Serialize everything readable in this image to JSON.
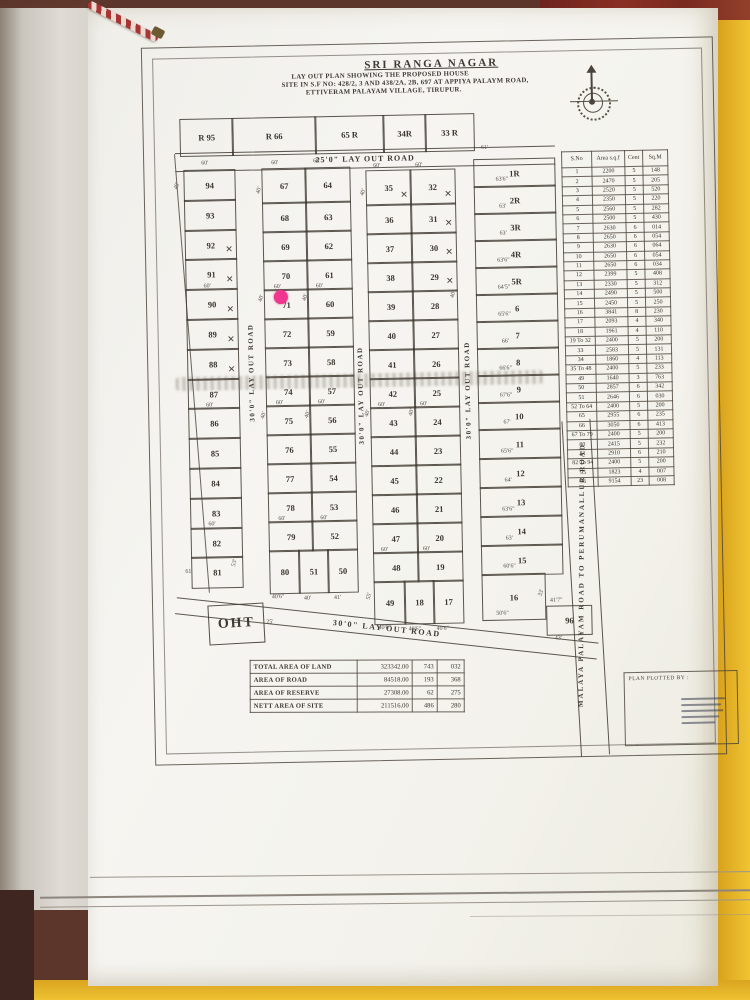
{
  "photo": {
    "folder_color": "#eec232",
    "cloth_color": "#8a2f24",
    "paper_color": "#f6f5f1",
    "ink_color": "#3e3933",
    "marker_color": "#f0368f"
  },
  "title": {
    "name": "SRI RANGA NAGAR",
    "line1": "LAY OUT PLAN SHOWING THE PROPOSED HOUSE",
    "line2": "SITE IN S.F NO: 428/2, 3 AND 438/2A, 2B, 697 AT APPIYA PALAYM ROAD,",
    "line3": "ETTIVERAM PALAYAM VILLAGE, TIRUPUR."
  },
  "roads": {
    "top": "25'0\" LAY OUT ROAD",
    "v1": "30'0\" LAY OUT ROAD",
    "v2": "30'0\" LAY OUT ROAD",
    "v3": "30'0\" LAY OUT ROAD",
    "bottom": "30'0\" LAY OUT ROAD",
    "right": "MALAYA PALAYAM ROAD TO PERUMANALLUR ROAD"
  },
  "oht_label": "OHT",
  "plotted_by_label": "PLAN PLOTTED BY :",
  "marker": {
    "on_plot": "71"
  },
  "area_table": {
    "headers": [
      "S.No",
      "Area s.q.f",
      "Cent",
      "Sq.M"
    ],
    "rows": [
      [
        "1",
        "2200",
        "5",
        "148"
      ],
      [
        "2",
        "2470",
        "5",
        "205"
      ],
      [
        "3",
        "2520",
        "5",
        "520"
      ],
      [
        "4",
        "2350",
        "5",
        "220"
      ],
      [
        "5",
        "2560",
        "5",
        "282"
      ],
      [
        "6",
        "2500",
        "5",
        "430"
      ],
      [
        "7",
        "2630",
        "6",
        "014"
      ],
      [
        "8",
        "2650",
        "6",
        "054"
      ],
      [
        "9",
        "2630",
        "6",
        "064"
      ],
      [
        "10",
        "2650",
        "6",
        "054"
      ],
      [
        "11",
        "2650",
        "6",
        "034"
      ],
      [
        "12",
        "2399",
        "5",
        "408"
      ],
      [
        "13",
        "2330",
        "5",
        "312"
      ],
      [
        "14",
        "2490",
        "5",
        "500"
      ],
      [
        "15",
        "2450",
        "5",
        "250"
      ],
      [
        "16",
        "3841",
        "8",
        "230"
      ],
      [
        "17",
        "2093",
        "4",
        "340"
      ],
      [
        "18",
        "1961",
        "4",
        "110"
      ],
      [
        "19 To 32",
        "2400",
        "5",
        "200"
      ],
      [
        "33",
        "2583",
        "5",
        "131"
      ],
      [
        "34",
        "1860",
        "4",
        "113"
      ],
      [
        "35 To 48",
        "2400",
        "5",
        "233"
      ],
      [
        "49",
        "1640",
        "3",
        "763"
      ],
      [
        "50",
        "2857",
        "6",
        "342"
      ],
      [
        "51",
        "2646",
        "6",
        "030"
      ],
      [
        "52 To 64",
        "2400",
        "5",
        "200"
      ],
      [
        "65",
        "2955",
        "6",
        "235"
      ],
      [
        "66",
        "3050",
        "6",
        "413"
      ],
      [
        "67 To 79",
        "2400",
        "5",
        "200"
      ],
      [
        "80",
        "2415",
        "5",
        "232"
      ],
      [
        "81",
        "2910",
        "6",
        "210"
      ],
      [
        "82 To 94",
        "2400",
        "5",
        "200"
      ],
      [
        "95",
        "1823",
        "4",
        "007"
      ],
      [
        "96",
        "9154",
        "23",
        "008"
      ]
    ]
  },
  "summary_table": {
    "rows": [
      [
        "TOTAL AREA OF LAND",
        "323342.00",
        "743",
        "032"
      ],
      [
        "AREA OF ROAD",
        "84518.00",
        "193",
        "368"
      ],
      [
        "AREA OF RESERVE",
        "27308.00",
        "62",
        "275"
      ],
      [
        "NETT AREA OF SITE",
        "211516.00",
        "486",
        "280"
      ]
    ]
  },
  "plots": {
    "cells": [
      {
        "n": "R 95",
        "x": 37,
        "y": 78,
        "w": 52,
        "h": 36
      },
      {
        "n": "R 66",
        "x": 89,
        "y": 78,
        "w": 83,
        "h": 36
      },
      {
        "n": "65 R",
        "x": 172,
        "y": 78,
        "w": 68,
        "h": 36
      },
      {
        "n": "34R",
        "x": 240,
        "y": 78,
        "w": 42,
        "h": 36
      },
      {
        "n": "33 R",
        "x": 282,
        "y": 78,
        "w": 48,
        "h": 36
      },
      {
        "n": "94",
        "x": 40,
        "y": 129,
        "w": 50,
        "h": 30
      },
      {
        "n": "93",
        "x": 40,
        "y": 159,
        "w": 50,
        "h": 30
      },
      {
        "n": "92",
        "x": 40,
        "y": 189,
        "w": 50,
        "h": 29,
        "cross": true
      },
      {
        "n": "91",
        "x": 40,
        "y": 218,
        "w": 50,
        "h": 30,
        "cross": true
      },
      {
        "n": "90",
        "x": 40,
        "y": 248,
        "w": 50,
        "h": 30,
        "cross": true
      },
      {
        "n": "89",
        "x": 40,
        "y": 278,
        "w": 50,
        "h": 30,
        "cross": true
      },
      {
        "n": "88",
        "x": 40,
        "y": 308,
        "w": 50,
        "h": 30,
        "cross": true
      },
      {
        "n": "87",
        "x": 40,
        "y": 338,
        "w": 50,
        "h": 29
      },
      {
        "n": "86",
        "x": 40,
        "y": 367,
        "w": 50,
        "h": 30
      },
      {
        "n": "85",
        "x": 40,
        "y": 397,
        "w": 50,
        "h": 30
      },
      {
        "n": "84",
        "x": 40,
        "y": 427,
        "w": 50,
        "h": 30
      },
      {
        "n": "83",
        "x": 40,
        "y": 457,
        "w": 50,
        "h": 30
      },
      {
        "n": "82",
        "x": 40,
        "y": 487,
        "w": 50,
        "h": 29
      },
      {
        "n": "81",
        "x": 40,
        "y": 516,
        "w": 50,
        "h": 30
      },
      {
        "n": "67",
        "x": 118,
        "y": 129,
        "w": 43,
        "h": 34
      },
      {
        "n": "68",
        "x": 118,
        "y": 163,
        "w": 43,
        "h": 29
      },
      {
        "n": "69",
        "x": 118,
        "y": 192,
        "w": 43,
        "h": 29
      },
      {
        "n": "70",
        "x": 118,
        "y": 221,
        "w": 43,
        "h": 29
      },
      {
        "n": "71",
        "x": 118,
        "y": 250,
        "w": 43,
        "h": 29
      },
      {
        "n": "72",
        "x": 118,
        "y": 279,
        "w": 43,
        "h": 29
      },
      {
        "n": "73",
        "x": 118,
        "y": 308,
        "w": 43,
        "h": 29
      },
      {
        "n": "74",
        "x": 118,
        "y": 337,
        "w": 43,
        "h": 29
      },
      {
        "n": "75",
        "x": 118,
        "y": 366,
        "w": 43,
        "h": 29
      },
      {
        "n": "76",
        "x": 118,
        "y": 395,
        "w": 43,
        "h": 29
      },
      {
        "n": "77",
        "x": 118,
        "y": 424,
        "w": 43,
        "h": 29
      },
      {
        "n": "78",
        "x": 118,
        "y": 453,
        "w": 43,
        "h": 29
      },
      {
        "n": "79",
        "x": 118,
        "y": 482,
        "w": 43,
        "h": 29
      },
      {
        "n": "64",
        "x": 161,
        "y": 129,
        "w": 44,
        "h": 34
      },
      {
        "n": "63",
        "x": 161,
        "y": 163,
        "w": 44,
        "h": 29
      },
      {
        "n": "62",
        "x": 161,
        "y": 192,
        "w": 44,
        "h": 29
      },
      {
        "n": "61",
        "x": 161,
        "y": 221,
        "w": 44,
        "h": 29
      },
      {
        "n": "60",
        "x": 161,
        "y": 250,
        "w": 44,
        "h": 29
      },
      {
        "n": "59",
        "x": 161,
        "y": 279,
        "w": 44,
        "h": 29
      },
      {
        "n": "58",
        "x": 161,
        "y": 308,
        "w": 44,
        "h": 29
      },
      {
        "n": "57",
        "x": 161,
        "y": 337,
        "w": 44,
        "h": 29
      },
      {
        "n": "56",
        "x": 161,
        "y": 366,
        "w": 44,
        "h": 29
      },
      {
        "n": "55",
        "x": 161,
        "y": 395,
        "w": 44,
        "h": 29
      },
      {
        "n": "54",
        "x": 161,
        "y": 424,
        "w": 44,
        "h": 29
      },
      {
        "n": "53",
        "x": 161,
        "y": 453,
        "w": 44,
        "h": 29
      },
      {
        "n": "52",
        "x": 161,
        "y": 482,
        "w": 44,
        "h": 29
      },
      {
        "n": "80",
        "x": 118,
        "y": 511,
        "w": 29,
        "h": 42
      },
      {
        "n": "51",
        "x": 147,
        "y": 511,
        "w": 29,
        "h": 42
      },
      {
        "n": "50",
        "x": 176,
        "y": 511,
        "w": 29,
        "h": 42
      },
      {
        "n": "35",
        "x": 222,
        "y": 133,
        "w": 44,
        "h": 34,
        "cross": true
      },
      {
        "n": "36",
        "x": 222,
        "y": 167,
        "w": 44,
        "h": 29
      },
      {
        "n": "37",
        "x": 222,
        "y": 196,
        "w": 44,
        "h": 29
      },
      {
        "n": "38",
        "x": 222,
        "y": 225,
        "w": 44,
        "h": 29
      },
      {
        "n": "39",
        "x": 222,
        "y": 254,
        "w": 44,
        "h": 29
      },
      {
        "n": "40",
        "x": 222,
        "y": 283,
        "w": 44,
        "h": 29
      },
      {
        "n": "41",
        "x": 222,
        "y": 312,
        "w": 44,
        "h": 29
      },
      {
        "n": "42",
        "x": 222,
        "y": 341,
        "w": 44,
        "h": 29
      },
      {
        "n": "43",
        "x": 222,
        "y": 370,
        "w": 44,
        "h": 29
      },
      {
        "n": "44",
        "x": 222,
        "y": 399,
        "w": 44,
        "h": 29
      },
      {
        "n": "45",
        "x": 222,
        "y": 428,
        "w": 44,
        "h": 29
      },
      {
        "n": "46",
        "x": 222,
        "y": 457,
        "w": 44,
        "h": 29
      },
      {
        "n": "47",
        "x": 222,
        "y": 486,
        "w": 44,
        "h": 29
      },
      {
        "n": "48",
        "x": 222,
        "y": 515,
        "w": 44,
        "h": 29
      },
      {
        "n": "32",
        "x": 266,
        "y": 133,
        "w": 44,
        "h": 34,
        "cross": true
      },
      {
        "n": "31",
        "x": 266,
        "y": 167,
        "w": 44,
        "h": 29,
        "cross": true
      },
      {
        "n": "30",
        "x": 266,
        "y": 196,
        "w": 44,
        "h": 29,
        "cross": true
      },
      {
        "n": "29",
        "x": 266,
        "y": 225,
        "w": 44,
        "h": 29,
        "cross": true
      },
      {
        "n": "28",
        "x": 266,
        "y": 254,
        "w": 44,
        "h": 29
      },
      {
        "n": "27",
        "x": 266,
        "y": 283,
        "w": 44,
        "h": 29
      },
      {
        "n": "26",
        "x": 266,
        "y": 312,
        "w": 44,
        "h": 29
      },
      {
        "n": "25",
        "x": 266,
        "y": 341,
        "w": 44,
        "h": 29
      },
      {
        "n": "24",
        "x": 266,
        "y": 370,
        "w": 44,
        "h": 29
      },
      {
        "n": "23",
        "x": 266,
        "y": 399,
        "w": 44,
        "h": 29
      },
      {
        "n": "22",
        "x": 266,
        "y": 428,
        "w": 44,
        "h": 29
      },
      {
        "n": "21",
        "x": 266,
        "y": 457,
        "w": 44,
        "h": 29
      },
      {
        "n": "20",
        "x": 266,
        "y": 486,
        "w": 44,
        "h": 29
      },
      {
        "n": "19",
        "x": 266,
        "y": 515,
        "w": 44,
        "h": 29
      },
      {
        "n": "49",
        "x": 222,
        "y": 544,
        "w": 30,
        "h": 42
      },
      {
        "n": "18",
        "x": 252,
        "y": 544,
        "w": 29,
        "h": 42
      },
      {
        "n": "17",
        "x": 281,
        "y": 544,
        "w": 29,
        "h": 42
      },
      {
        "n": "1R",
        "x": 330,
        "y": 124,
        "w": 80,
        "h": 27
      },
      {
        "n": "2R",
        "x": 330,
        "y": 151,
        "w": 80,
        "h": 27
      },
      {
        "n": "3R",
        "x": 330,
        "y": 178,
        "w": 80,
        "h": 27
      },
      {
        "n": "4R",
        "x": 330,
        "y": 205,
        "w": 80,
        "h": 27
      },
      {
        "n": "5R",
        "x": 330,
        "y": 232,
        "w": 80,
        "h": 27
      },
      {
        "n": "6",
        "x": 330,
        "y": 259,
        "w": 80,
        "h": 27
      },
      {
        "n": "7",
        "x": 330,
        "y": 286,
        "w": 80,
        "h": 27
      },
      {
        "n": "8",
        "x": 330,
        "y": 313,
        "w": 80,
        "h": 27
      },
      {
        "n": "9",
        "x": 330,
        "y": 340,
        "w": 80,
        "h": 27
      },
      {
        "n": "10",
        "x": 330,
        "y": 367,
        "w": 80,
        "h": 27
      },
      {
        "n": "11",
        "x": 330,
        "y": 394,
        "w": 80,
        "h": 29
      },
      {
        "n": "12",
        "x": 330,
        "y": 423,
        "w": 80,
        "h": 29
      },
      {
        "n": "13",
        "x": 330,
        "y": 452,
        "w": 80,
        "h": 29
      },
      {
        "n": "14",
        "x": 330,
        "y": 481,
        "w": 80,
        "h": 29
      },
      {
        "n": "15",
        "x": 330,
        "y": 510,
        "w": 80,
        "h": 29
      },
      {
        "n": "16",
        "x": 330,
        "y": 539,
        "w": 62,
        "h": 45
      },
      {
        "n": "96",
        "x": 394,
        "y": 572,
        "w": 44,
        "h": 28
      }
    ]
  },
  "dims": [
    {
      "t": "60'",
      "x": 58,
      "y": 120
    },
    {
      "t": "40'",
      "x": 30,
      "y": 142,
      "r": -70
    },
    {
      "t": "60'",
      "x": 128,
      "y": 121
    },
    {
      "t": "60'",
      "x": 170,
      "y": 120
    },
    {
      "t": "40'",
      "x": 112,
      "y": 148,
      "r": -70
    },
    {
      "t": "60'",
      "x": 230,
      "y": 126
    },
    {
      "t": "60'",
      "x": 272,
      "y": 126
    },
    {
      "t": "40'",
      "x": 216,
      "y": 152,
      "r": -70
    },
    {
      "t": "61'",
      "x": 338,
      "y": 110
    },
    {
      "t": "63'6\"",
      "x": 352,
      "y": 142
    },
    {
      "t": "63'",
      "x": 355,
      "y": 169
    },
    {
      "t": "63'",
      "x": 355,
      "y": 196
    },
    {
      "t": "63'6\"",
      "x": 352,
      "y": 223
    },
    {
      "t": "64'5\"",
      "x": 352,
      "y": 250
    },
    {
      "t": "65'6\"",
      "x": 352,
      "y": 277
    },
    {
      "t": "66'",
      "x": 355,
      "y": 304
    },
    {
      "t": "66'6\"",
      "x": 352,
      "y": 331
    },
    {
      "t": "67'6\"",
      "x": 352,
      "y": 358
    },
    {
      "t": "67'",
      "x": 355,
      "y": 385
    },
    {
      "t": "65'6\"",
      "x": 352,
      "y": 414
    },
    {
      "t": "64'",
      "x": 355,
      "y": 443
    },
    {
      "t": "63'6\"",
      "x": 352,
      "y": 472
    },
    {
      "t": "63'",
      "x": 355,
      "y": 501
    },
    {
      "t": "60'6\"",
      "x": 352,
      "y": 529
    },
    {
      "t": "50'6\"",
      "x": 344,
      "y": 576
    },
    {
      "t": "41'7\"",
      "x": 398,
      "y": 564
    },
    {
      "t": "43'",
      "x": 402,
      "y": 602
    },
    {
      "t": "60'",
      "x": 58,
      "y": 243
    },
    {
      "t": "60'",
      "x": 128,
      "y": 245
    },
    {
      "t": "60'",
      "x": 170,
      "y": 245
    },
    {
      "t": "60'",
      "x": 58,
      "y": 362
    },
    {
      "t": "60'",
      "x": 128,
      "y": 361
    },
    {
      "t": "60'",
      "x": 170,
      "y": 361
    },
    {
      "t": "60'",
      "x": 58,
      "y": 481
    },
    {
      "t": "60'",
      "x": 128,
      "y": 477
    },
    {
      "t": "60'",
      "x": 170,
      "y": 477
    },
    {
      "t": "60'",
      "x": 230,
      "y": 365
    },
    {
      "t": "60'",
      "x": 272,
      "y": 365
    },
    {
      "t": "60'",
      "x": 230,
      "y": 510
    },
    {
      "t": "60'",
      "x": 272,
      "y": 510
    },
    {
      "t": "40'",
      "x": 112,
      "y": 256,
      "r": -70
    },
    {
      "t": "40'",
      "x": 156,
      "y": 256,
      "r": -70
    },
    {
      "t": "40'",
      "x": 112,
      "y": 373,
      "r": -70
    },
    {
      "t": "40'",
      "x": 156,
      "y": 373,
      "r": -70
    },
    {
      "t": "40'",
      "x": 216,
      "y": 373,
      "r": -70
    },
    {
      "t": "40'",
      "x": 260,
      "y": 373,
      "r": -70
    },
    {
      "t": "40'",
      "x": 304,
      "y": 256,
      "r": -70
    },
    {
      "t": "61'",
      "x": 34,
      "y": 528
    },
    {
      "t": "53'",
      "x": 80,
      "y": 520,
      "r": -75
    },
    {
      "t": "55'",
      "x": 214,
      "y": 556,
      "r": -75
    },
    {
      "t": "25'",
      "x": 114,
      "y": 580
    },
    {
      "t": "40'6\"",
      "x": 120,
      "y": 555
    },
    {
      "t": "40'",
      "x": 152,
      "y": 557
    },
    {
      "t": "41'",
      "x": 182,
      "y": 557
    },
    {
      "t": "40'6\"",
      "x": 226,
      "y": 588
    },
    {
      "t": "40'6\"",
      "x": 256,
      "y": 590
    },
    {
      "t": "40'6\"",
      "x": 284,
      "y": 590
    },
    {
      "t": "33'",
      "x": 386,
      "y": 556,
      "r": -70
    }
  ]
}
